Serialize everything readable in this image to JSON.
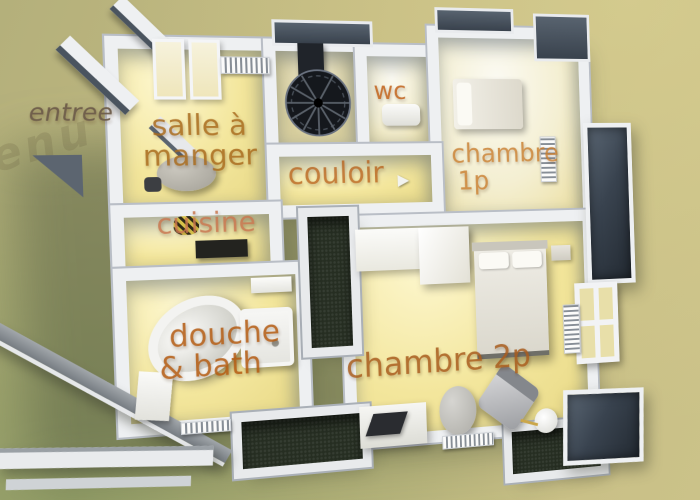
{
  "watermark": "enu",
  "palette": {
    "background_khaki": "#c3ba81",
    "background_green": "#9aa379",
    "wall_white": "#eef0f2",
    "wall_face_slate": "#39434f",
    "floor_yellow": "#f3e69c",
    "floor_light": "#f4efd2",
    "terrace_dark": "#262e22",
    "label_orange": "#b45a14",
    "label_gray_brown": "#6d5c49"
  },
  "rooms": [
    {
      "id": "entree",
      "lines": [
        "entree"
      ],
      "color": "#6d5c49"
    },
    {
      "id": "salle-a-manger",
      "lines": [
        "salle à",
        "manger"
      ],
      "color": "#a86a1c"
    },
    {
      "id": "wc",
      "lines": [
        "wc"
      ],
      "color": "#c06018"
    },
    {
      "id": "couloir",
      "lines": [
        "couloir"
      ],
      "color": "#b55b14"
    },
    {
      "id": "chambre-1p",
      "lines": [
        "chambre",
        "1p"
      ],
      "color": "#c87c2c"
    },
    {
      "id": "cuisine",
      "lines": [
        "cuisine"
      ],
      "color": "#c8764f"
    },
    {
      "id": "douche-bath",
      "lines": [
        "douche",
        "& bath"
      ],
      "color": "#b35a10"
    },
    {
      "id": "chambre-2p",
      "lines": [
        "chambre 2p"
      ],
      "color": "#a85c1d"
    }
  ],
  "furniture": [
    "spiral-staircase",
    "dining-table",
    "window-panes",
    "radiator",
    "kitchen-counter",
    "plant-decor",
    "bathtub",
    "shower-tray",
    "bathroom-cabinet",
    "washbasin",
    "single-bed",
    "double-bed",
    "pillows",
    "nightstand",
    "wardrobe",
    "shelf-unit",
    "armchair",
    "round-table",
    "floor-lamp",
    "desk",
    "laptop"
  ]
}
